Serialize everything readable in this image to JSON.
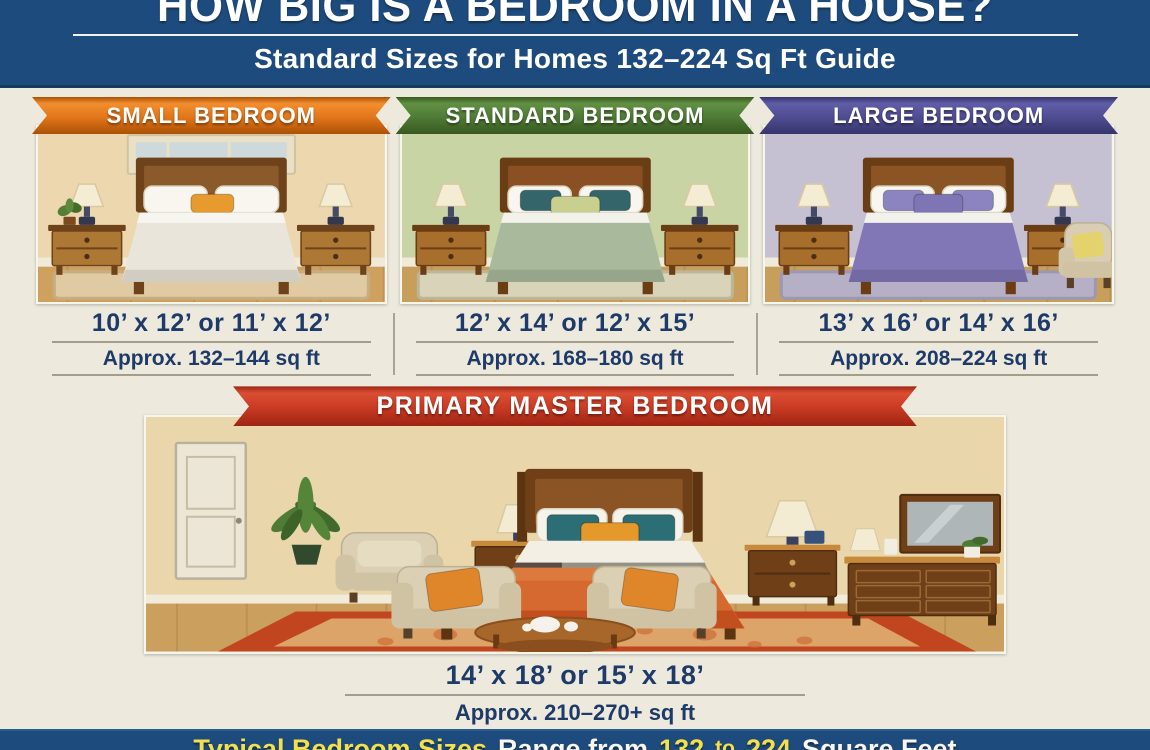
{
  "header": {
    "title": "HOW BIG IS A BEDROOM IN A HOUSE?",
    "subtitle": "Standard Sizes for Homes 132–224 Sq Ft Guide",
    "background": "#1d4b7d"
  },
  "panels": [
    {
      "label": "SMALL BEDROOM",
      "dims": "10’ x 12’ or 11’ x 12’",
      "approx": "Approx. 132–144 sq ft",
      "ribbon": {
        "main": "#e2761a",
        "edge": "#ab5106",
        "light": "#f28e2e"
      },
      "scene": {
        "wall": "#ecd7ae",
        "floor": "#cfa15f",
        "rug": "#dfcaa4",
        "rug_edge": "#c8ad80",
        "blanket": "#e9e5da",
        "blanket_fold": "#f7f5ef",
        "headboard": "#8a5a2b",
        "wood": "#ad7833",
        "wood_dark": "#6e421a",
        "window": true,
        "plant": true,
        "armchair": false,
        "accent_pillows": [
          {
            "x": 150,
            "y": 66,
            "w": 42,
            "h": 18,
            "color": "#e79a2e"
          }
        ]
      }
    },
    {
      "label": "STANDARD BEDROOM",
      "dims": "12’ x 14’ or 12’ x 15’",
      "approx": "Approx. 168–180 sq ft",
      "ribbon": {
        "main": "#4f7b36",
        "edge": "#38591f",
        "light": "#619043"
      },
      "scene": {
        "wall": "#c8d4a4",
        "floor": "#c79e5c",
        "rug": "#d9d3ba",
        "rug_edge": "#bdb696",
        "blanket": "#a9b99b",
        "blanket_fold": "#f3f2ea",
        "headboard": "#8a4f22",
        "wood": "#a76e2c",
        "wood_dark": "#6b3d15",
        "window": false,
        "plant": false,
        "armchair": false,
        "accent_pillows": [
          {
            "x": 116,
            "y": 62,
            "w": 40,
            "h": 20,
            "color": "#33656a"
          },
          {
            "x": 184,
            "y": 62,
            "w": 40,
            "h": 20,
            "color": "#33656a"
          },
          {
            "x": 146,
            "y": 68,
            "w": 48,
            "h": 18,
            "color": "#c9cf8e"
          }
        ]
      }
    },
    {
      "label": "LARGE BEDROOM",
      "dims": "13’ x 16’ or 14’ x 16’",
      "approx": "Approx. 208–224 sq ft",
      "ribbon": {
        "main": "#4f4c92",
        "edge": "#37356c",
        "light": "#605da8"
      },
      "scene": {
        "wall": "#c6c1d2",
        "floor": "#c79e5c",
        "rug": "#b6b0c6",
        "rug_edge": "#9d97b2",
        "blanket": "#8177b6",
        "blanket_fold": "#f3f2ea",
        "headboard": "#8a5424",
        "wood": "#a76e2c",
        "wood_dark": "#6b3d15",
        "window": false,
        "plant": false,
        "armchair": true,
        "accent_pillows": [
          {
            "x": 116,
            "y": 62,
            "w": 40,
            "h": 20,
            "color": "#8b84c0"
          },
          {
            "x": 184,
            "y": 62,
            "w": 40,
            "h": 20,
            "color": "#8b84c0"
          },
          {
            "x": 146,
            "y": 66,
            "w": 48,
            "h": 20,
            "color": "#7e76b4"
          }
        ]
      }
    }
  ],
  "master": {
    "label": "PRIMARY MASTER BEDROOM",
    "dims": "14’ x 18’ or 15’ x 18’",
    "approx": "Approx. 210–270+ sq ft",
    "ribbon": {
      "main": "#c93a23",
      "edge": "#9c2413",
      "light": "#da4e33"
    },
    "scene": {
      "wall": "#e9d6ab",
      "floor": "#cb9f5e",
      "rug_border": "#c1451f",
      "rug_field": "#dca468",
      "wood": "#6f3f17",
      "wood_top": "#c78a3c",
      "wood_dark": "#4f2d10",
      "wood_inner": "#8a5424",
      "blanket": "#d6692f",
      "blanket_dark": "#c14c1e",
      "blanket_light": "#e0854a",
      "teal_pillow": "#2c6e76",
      "orange_pillow": "#e6992b",
      "sofa": "#dbd0b4",
      "sofa_dark": "#cfc3a4",
      "sofa_pillow": "#e0862a",
      "door": "#ece6d6",
      "plant": "#4e7c34",
      "lamp": "#f4ecd2",
      "mirror": "#aeb6b8"
    }
  },
  "footer": {
    "background": "#1d4b7d",
    "segments": [
      {
        "text": "Typical Bedroom Sizes",
        "color": "#f2e04e",
        "size": 27
      },
      {
        "text": "Range from",
        "color": "#f8f6ee",
        "size": 27
      },
      {
        "text": "132",
        "color": "#f2e04e",
        "size": 27
      },
      {
        "text": "to",
        "color": "#f2e04e",
        "size": 21
      },
      {
        "text": "224",
        "color": "#f2e04e",
        "size": 27
      },
      {
        "text": "Square Feet",
        "color": "#f8f6ee",
        "size": 27
      }
    ]
  }
}
